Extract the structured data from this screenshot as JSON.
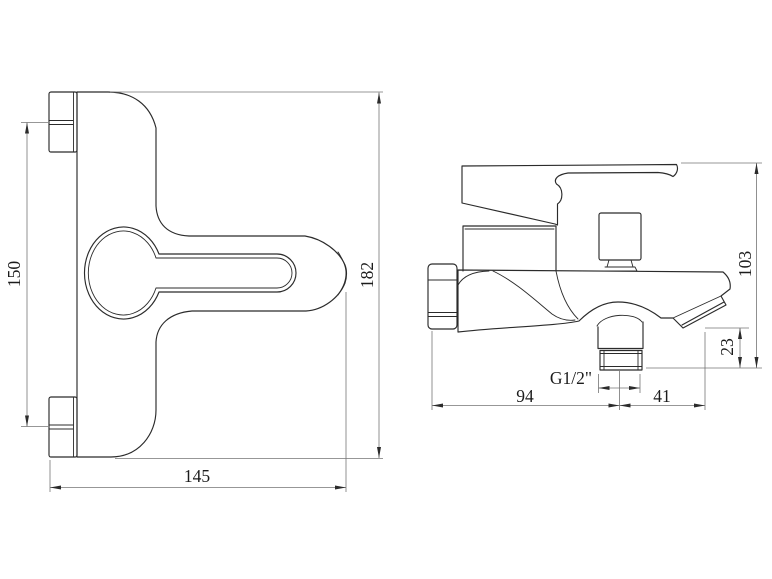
{
  "page": {
    "background": "#ffffff"
  },
  "drawing": {
    "type": "technical-dimension-drawing",
    "subject": "wall-mounted bath/shower mixer faucet",
    "views": [
      {
        "name": "front view",
        "dimensions": [
          "150",
          "182",
          "145"
        ]
      },
      {
        "name": "side view",
        "dimensions": [
          "103",
          "23",
          "94",
          "41",
          "G1/2\""
        ]
      }
    ],
    "colors": {
      "object_line": "#2b2b2b",
      "dimension_line": "#757575",
      "text": "#1c1c1c",
      "background": "#ffffff"
    },
    "dims": {
      "ports_spacing": "150",
      "front_height": "182",
      "front_width": "145",
      "side_height": "103",
      "spout_drop": "23",
      "wall_to_outlet": "94",
      "outlet_to_tip": "41",
      "thread_size": "G1/2\""
    }
  }
}
